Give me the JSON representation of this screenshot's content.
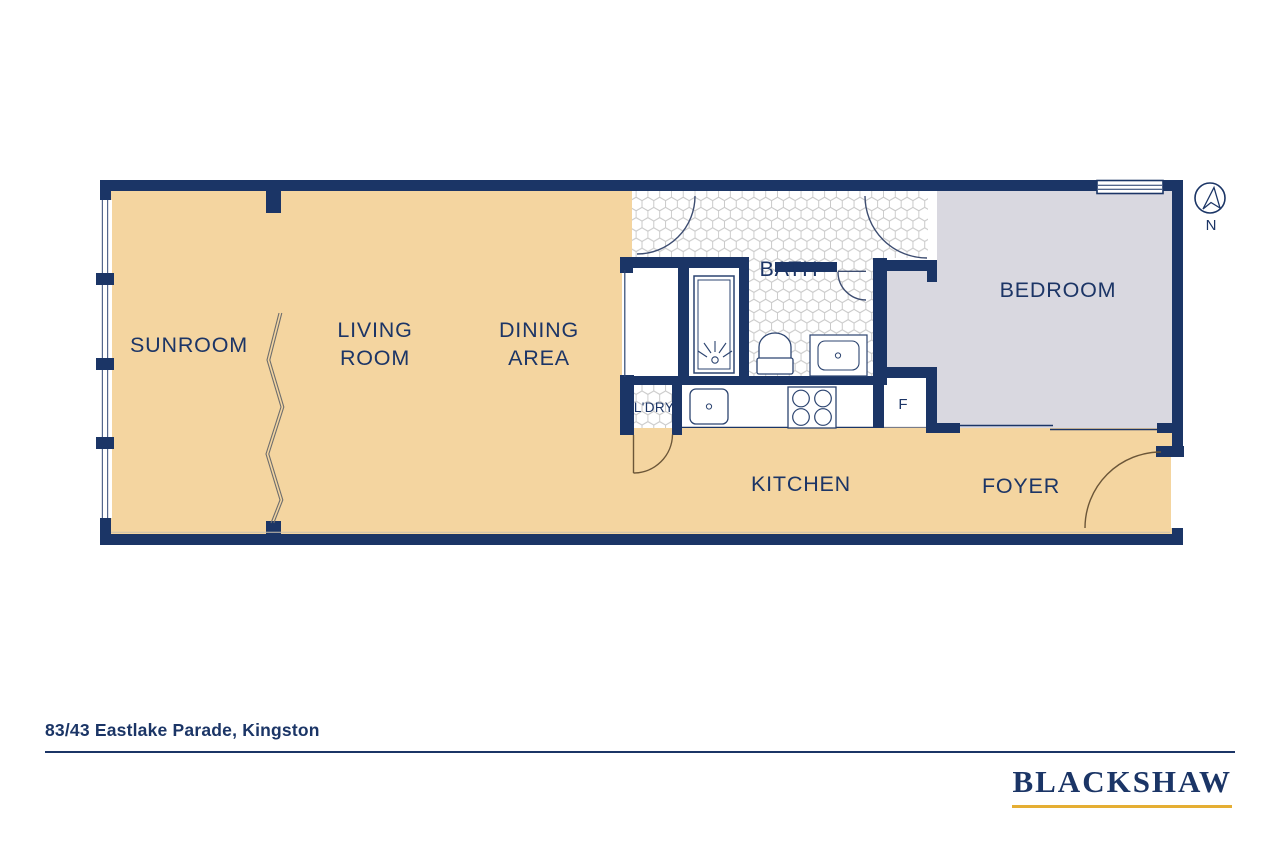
{
  "rooms": {
    "sunroom": "SUNROOM",
    "living_line1": "LIVING",
    "living_line2": "ROOM",
    "dining_line1": "DINING",
    "dining_line2": "AREA",
    "bath": "BATH",
    "bedroom": "BEDROOM",
    "kitchen": "KITCHEN",
    "foyer": "FOYER",
    "laundry": "L'DRY",
    "fridge": "F"
  },
  "compass": {
    "north": "N"
  },
  "footer": {
    "address": "83/43 Eastlake Parade, Kingston",
    "brand": "BLACKSHAW"
  },
  "colors": {
    "wall_navy": "#1b3566",
    "floor_tan": "#f4d5a0",
    "bedroom_gray": "#d9d8e0",
    "tile_line": "#c9c9c9",
    "brand_gold": "#e5ae33"
  }
}
